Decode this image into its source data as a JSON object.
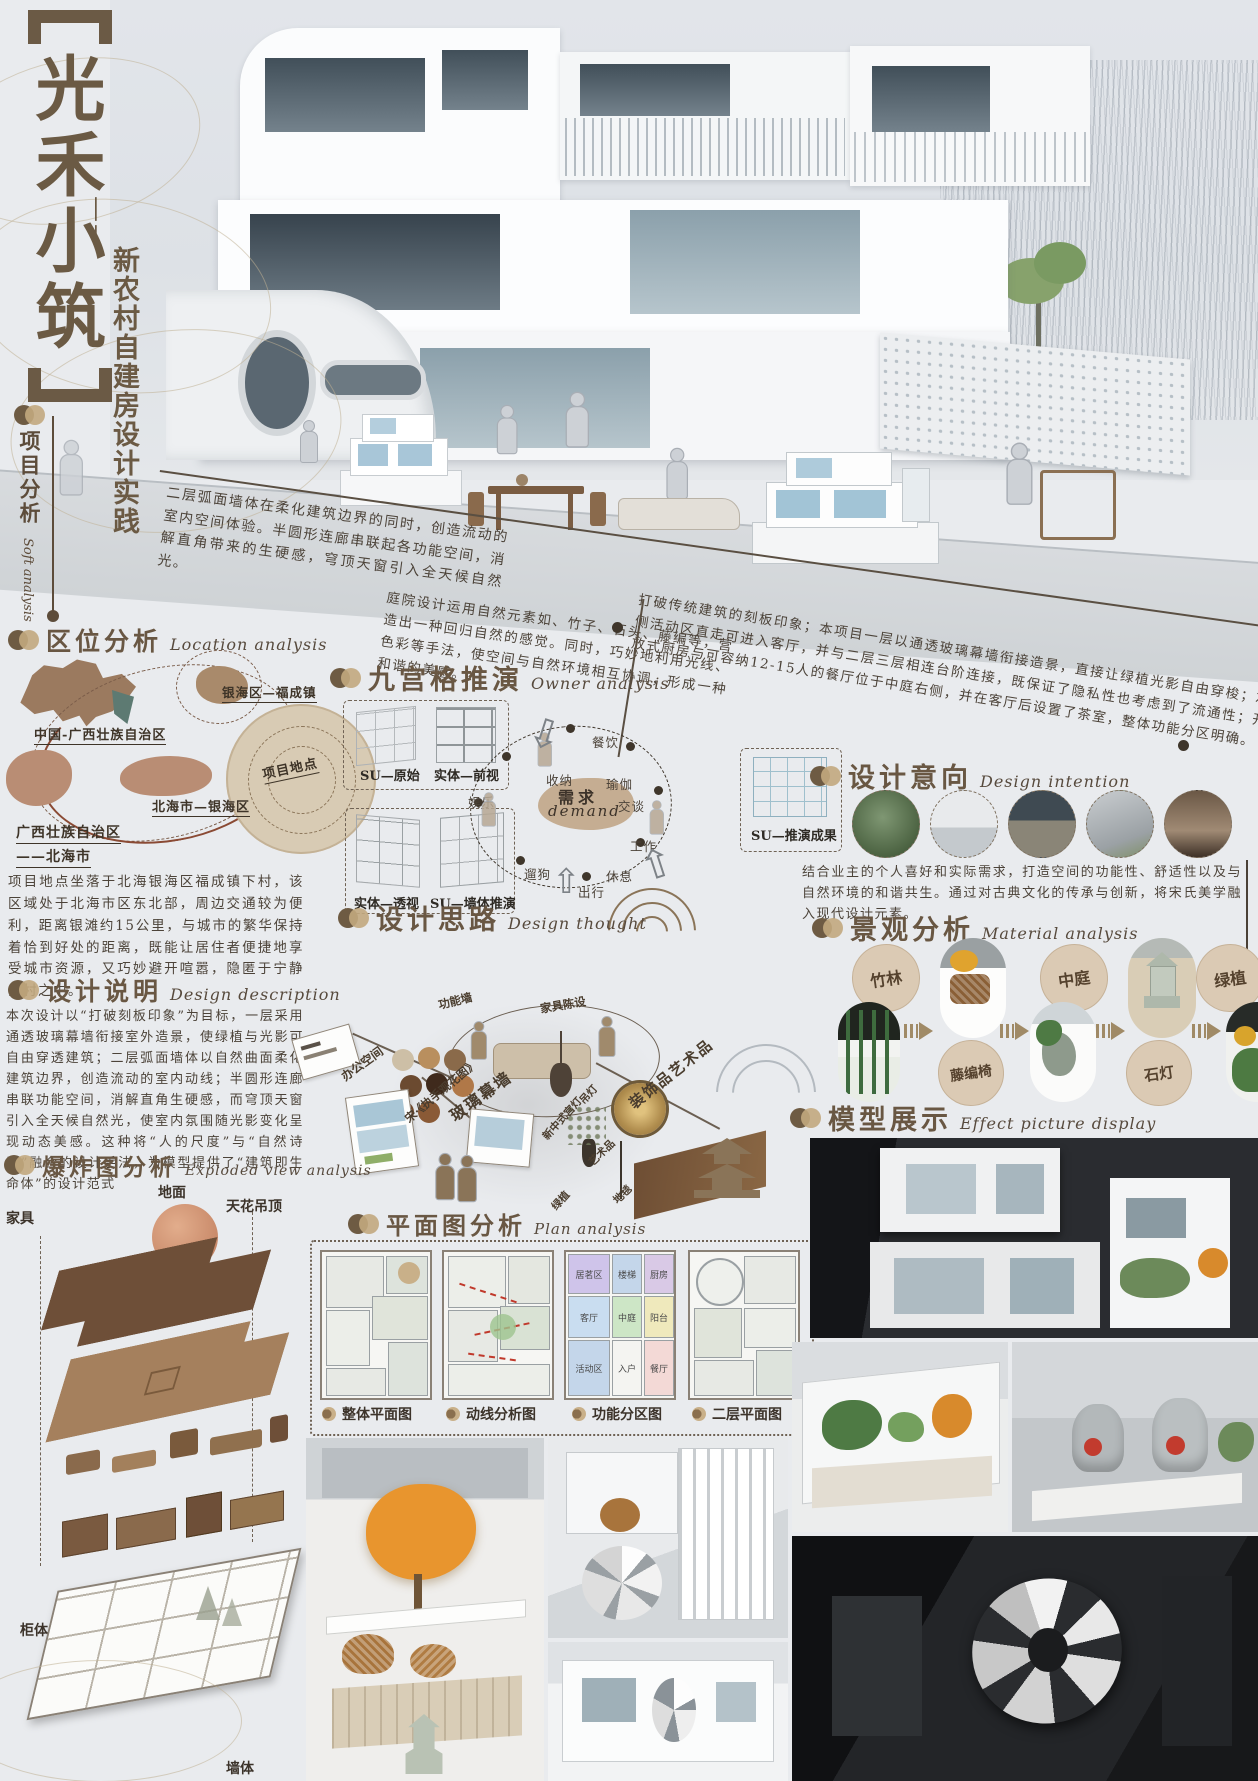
{
  "header": {
    "title_vertical": "光禾小筑",
    "subtitle_dashes": "——",
    "subtitle_vertical": "新农村自建房设计实践",
    "side_tab_zh": "项目分析",
    "side_tab_en": "Soft analysis"
  },
  "diagonal_notes": {
    "left": "二层弧面墙体在柔化建筑边界的同时，创造流动的室内空间体验。半圆形连廊串联起各功能空间，消解直角带来的生硬感，穹顶天窗引入全天候自然光。",
    "middle": "庭院设计运用自然元素如、竹子、石头、藤编等，营造出一种回归自然的感觉。同时，巧妙地利用光线、色彩等手法，使空间与自然环境相互协调，形成一种和谐的美感。",
    "right": "打破传统建筑的刻板印象；本项目一层以通透玻璃幕墙衔接造景，直接让绿植光影自由穿梭；左侧活动区直走可进入客厅，并与二层三层相连台阶连接，既保证了隐私性也考虑到了流通性；开放式厨房与可容纳12-15人的餐厅位于中庭右侧，并在客厅后设置了茶室，整体功能分区明确。"
  },
  "location": {
    "zh": "区位分析",
    "en": "Location analysis",
    "labels": {
      "yinhai": "银海区—福成镇",
      "china": "中国-广西壮族自治区",
      "site": "项目地点",
      "beihai": "北海市—银海区",
      "guangxi_1": "广西壮族自治区",
      "guangxi_2": "——北海市"
    },
    "para": "项目地点坐落于北海银海区福成镇下村，该区域处于北海市区东北部，周边交通较为便利，距离银滩约15公里，与城市的繁华保持着恰到好处的距离，既能让居住者便捷地享受城市资源，又巧妙避开喧嚣，隐匿于宁静乡村之中。"
  },
  "ninegrid": {
    "zh": "九宫格推演",
    "en": "Owner analysis",
    "boxes": [
      "SU—原始",
      "实体—前视",
      "实体—透视",
      "SU—墙体推演",
      "SU—推演成果"
    ],
    "demand": {
      "zh": "需求",
      "en": "demand",
      "labels": [
        "餐饮",
        "收纳",
        "瑜伽",
        "交谈",
        "工作",
        "休息",
        "出行",
        "遛狗",
        "娱乐"
      ]
    }
  },
  "intention": {
    "zh": "设计意向",
    "en": "Design intention",
    "para": "结合业主的个人喜好和实际需求，打造空间的功能性、舒适性以及与自然环境的和谐共生。通过对古典文化的传承与创新，将宋氏美学融入现代设计元素。"
  },
  "thought": {
    "zh": "设计思路",
    "en": "Design thought",
    "labels": [
      "办公空间",
      "功能墙",
      "家具陈设",
      "宋·《执手观花图》",
      "玻璃幕墙",
      "新中式宫灯",
      "吊灯",
      "装饰品艺术品",
      "艺术品",
      "绿植",
      "地毯"
    ]
  },
  "material": {
    "zh": "景观分析",
    "en": "Material analysis",
    "items": [
      "竹林",
      "藤编椅",
      "中庭",
      "石灯",
      "绿植"
    ]
  },
  "description": {
    "zh": "设计说明",
    "en": "Design description",
    "para": "本次设计以“打破刻板印象”为目标，一层采用通透玻璃幕墙衔接室外造景，使绿植与光影可自由穿透建筑；二层弧面墙体以自然曲面柔化建筑边界，创造流动的室内动线；半圆形连廊串联功能空间，消解直角生硬感，而穹顶天窗引入全天候自然光，使室内氛围随光影变化呈现动态美感。这种将“人的尺度”与“自然诗意”融合的设计手法，为模型提供了“建筑即生命体”的设计范式"
  },
  "exploded": {
    "zh": "爆炸图分析",
    "en": "Exploded view analysis",
    "labels": {
      "ground": "地面",
      "ceiling": "天花吊顶",
      "furniture": "家具",
      "cabinet": "柜体",
      "wall": "墙体"
    }
  },
  "plan": {
    "zh": "平面图分析",
    "en": "Plan analysis",
    "legend": [
      "整体平面图",
      "动线分析图",
      "功能分区图",
      "二层平面图"
    ],
    "rooms": [
      "居茗区",
      "楼梯",
      "厨房",
      "客厅",
      "中庭",
      "阳台",
      "活动区",
      "入户",
      "餐厅"
    ]
  },
  "model": {
    "zh": "模型展示",
    "en": "Effect picture display"
  }
}
